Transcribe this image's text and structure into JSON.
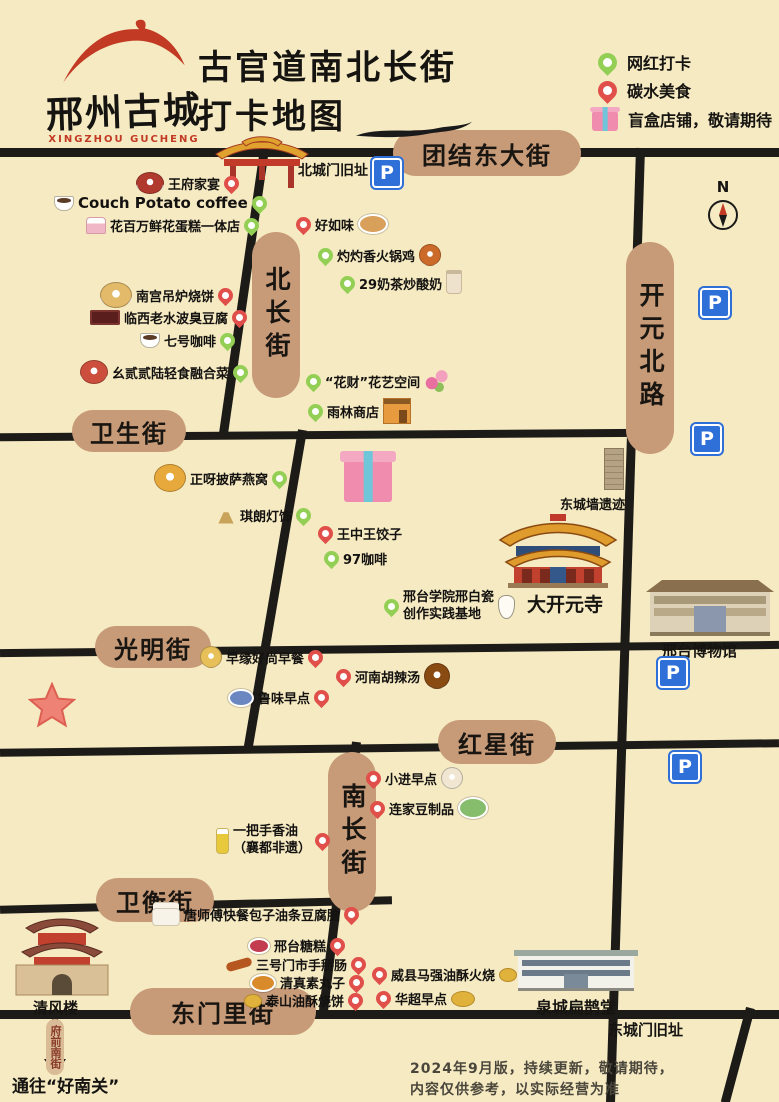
{
  "meta": {
    "logo_cn": "邢州古城",
    "logo_en": "XINGZHOU GUCHENG",
    "title_line1": "古官道南北长街",
    "title_line2": "打卡地图",
    "compass": "N"
  },
  "colors": {
    "background": "#f5eac2",
    "road": "#1d1b17",
    "street_pill": "#c79a78",
    "pin_red": "#e04f4a",
    "pin_green": "#94cf55",
    "parking_blue": "#2f6fd8",
    "logo_red": "#c23a24"
  },
  "legend": {
    "items": [
      {
        "icon": "green-pin",
        "label": "网红打卡"
      },
      {
        "icon": "red-pin",
        "label": "碳水美食"
      },
      {
        "icon": "giftbox",
        "label": "盲盒店铺，敬请期待"
      }
    ]
  },
  "streets": [
    {
      "label": "团结东大街"
    },
    {
      "label": "北长街"
    },
    {
      "label": "开元北路"
    },
    {
      "label": "卫生街"
    },
    {
      "label": "光明街"
    },
    {
      "label": "红星街"
    },
    {
      "label": "南长街"
    },
    {
      "label": "卫衡街"
    },
    {
      "label": "东门里街"
    }
  ],
  "landmarks": {
    "north_gate": "北城门旧址",
    "wall_relic": "东城墙遗迹",
    "temple": "大开元寺",
    "museum": "邢台博物馆",
    "quancheng_hall": "泉城扁鹊堂",
    "east_gate": "东城门旧址",
    "qingfeng_tower": "清风楼",
    "fuqian_street": "府前南街",
    "to_haonanguan": "通往“好南关”"
  },
  "notes": {
    "line1": "2024年9月版，持续更新，敬请期待，",
    "line2": "内容仅供参考，以实际经营为准"
  },
  "parking": {
    "label": "P",
    "positions": [
      {
        "x": 372,
        "y": 158
      },
      {
        "x": 700,
        "y": 288
      },
      {
        "x": 692,
        "y": 424
      },
      {
        "x": 658,
        "y": 658
      },
      {
        "x": 670,
        "y": 752
      }
    ]
  },
  "pois": [
    {
      "id": "wangfu-jiayan",
      "label": "王府家宴",
      "pin": "red",
      "icon": {
        "type": "round",
        "color": "#b03a2e",
        "w": 26,
        "h": 20
      },
      "order": [
        "icon",
        "label",
        "pin"
      ],
      "x": 136,
      "y": 172
    },
    {
      "id": "couch-potato-coffee",
      "label": "Couch Potato coffee",
      "pin": "green",
      "icon": {
        "type": "cup"
      },
      "order": [
        "icon",
        "label",
        "pin"
      ],
      "x": 54,
      "y": 194,
      "fs": 15
    },
    {
      "id": "huabaiwan-cake",
      "label": "花百万鲜花蛋糕一体店",
      "pin": "green",
      "icon": {
        "type": "cake"
      },
      "order": [
        "icon",
        "label",
        "pin"
      ],
      "x": 86,
      "y": 216
    },
    {
      "id": "haoruwei",
      "label": "好如味",
      "pin": "red",
      "icon": {
        "type": "oval",
        "color": "#d9a05b",
        "w": 26,
        "h": 16
      },
      "order": [
        "pin",
        "label",
        "icon"
      ],
      "x": 296,
      "y": 214
    },
    {
      "id": "zhuozhuoxiang",
      "label": "灼灼香火锅鸡",
      "pin": "green",
      "icon": {
        "type": "round",
        "color": "#cc6b29"
      },
      "order": [
        "pin",
        "label",
        "icon"
      ],
      "x": 318,
      "y": 244
    },
    {
      "id": "naicha-29",
      "label": "29奶茶炒酸奶",
      "pin": "green",
      "icon": {
        "type": "drink"
      },
      "order": [
        "pin",
        "label",
        "icon"
      ],
      "x": 340,
      "y": 272
    },
    {
      "id": "nangong-shaobing",
      "label": "南宫吊炉烧饼",
      "pin": "red",
      "icon": {
        "type": "round",
        "color": "#e3b96a",
        "w": 30,
        "h": 24
      },
      "order": [
        "icon",
        "label",
        "pin"
      ],
      "x": 100,
      "y": 282
    },
    {
      "id": "linxi-choudoufu",
      "label": "临西老水波臭豆腐",
      "pin": "red",
      "icon": {
        "type": "sign"
      },
      "order": [
        "icon",
        "label",
        "pin"
      ],
      "x": 90,
      "y": 308
    },
    {
      "id": "qihao-coffee",
      "label": "七号咖啡",
      "pin": "green",
      "icon": {
        "type": "cup"
      },
      "order": [
        "icon",
        "label",
        "pin"
      ],
      "x": 140,
      "y": 331
    },
    {
      "id": "yao-2226",
      "label": "幺贰贰陆轻食融合菜",
      "pin": "green",
      "icon": {
        "type": "round",
        "color": "#cc4f3d",
        "w": 26,
        "h": 22
      },
      "order": [
        "icon",
        "label",
        "pin"
      ],
      "x": 80,
      "y": 360
    },
    {
      "id": "huacai-flower",
      "label": "“花财”花艺空间",
      "pin": "green",
      "icon": {
        "type": "flower"
      },
      "order": [
        "pin",
        "label",
        "icon"
      ],
      "x": 306,
      "y": 370
    },
    {
      "id": "yulin-shop",
      "label": "雨林商店",
      "pin": "green",
      "icon": {
        "type": "shop"
      },
      "order": [
        "pin",
        "label",
        "icon"
      ],
      "x": 308,
      "y": 398
    },
    {
      "id": "pizza-yanwo",
      "label": "正呀披萨燕窝",
      "pin": "green",
      "icon": {
        "type": "round",
        "color": "#e8a93c",
        "w": 30,
        "h": 26
      },
      "order": [
        "icon",
        "label",
        "pin"
      ],
      "x": 154,
      "y": 464
    },
    {
      "id": "qilang-lighting",
      "label": "琪朗灯饰",
      "pin": "green",
      "icon": {
        "type": "lamp"
      },
      "order": [
        "icon",
        "label",
        "pin"
      ],
      "x": 216,
      "y": 506
    },
    {
      "id": "wangzhongwang-jiaozi",
      "label": "王中王饺子",
      "pin": "red",
      "order": [
        "pin",
        "label"
      ],
      "x": 318,
      "y": 524
    },
    {
      "id": "coffee-97",
      "label": "97咖啡",
      "pin": "green",
      "order": [
        "pin",
        "label"
      ],
      "x": 324,
      "y": 549
    },
    {
      "id": "xingtai-xueyuan",
      "lines": [
        "邢台学院邢白瓷",
        "创作实践基地"
      ],
      "pin": "green",
      "icon": {
        "type": "vase"
      },
      "order": [
        "pin",
        "label",
        "icon"
      ],
      "x": 384,
      "y": 590
    },
    {
      "id": "zaoyuan-breakfast",
      "label": "早缘好尚早餐",
      "pin": "red",
      "icon": {
        "type": "round",
        "color": "#e8c05a"
      },
      "order": [
        "icon",
        "label",
        "pin"
      ],
      "x": 200,
      "y": 646
    },
    {
      "id": "henan-hulatang",
      "label": "河南胡辣汤",
      "pin": "red",
      "icon": {
        "type": "round",
        "color": "#8a4b12",
        "w": 24,
        "h": 24
      },
      "order": [
        "pin",
        "label",
        "icon"
      ],
      "x": 336,
      "y": 663
    },
    {
      "id": "luwei-breakfast",
      "label": "鲁味早点",
      "pin": "red",
      "icon": {
        "type": "oval",
        "color": "#6a87c2"
      },
      "order": [
        "icon",
        "label",
        "pin"
      ],
      "x": 228,
      "y": 688
    },
    {
      "id": "xiaojin-breakfast",
      "label": "小进早点",
      "pin": "red",
      "icon": {
        "type": "round",
        "color": "#f0e6d2"
      },
      "order": [
        "pin",
        "label",
        "icon"
      ],
      "x": 366,
      "y": 767
    },
    {
      "id": "lianjia-tofu",
      "label": "连家豆制品",
      "pin": "red",
      "icon": {
        "type": "oval",
        "color": "#86bd6d",
        "w": 26,
        "h": 18
      },
      "order": [
        "pin",
        "label",
        "icon"
      ],
      "x": 370,
      "y": 797
    },
    {
      "id": "yibashou-oil",
      "lines": [
        "一把手香油",
        "（襄都非遗）"
      ],
      "pin": "red",
      "icon": {
        "type": "bottle"
      },
      "order": [
        "icon",
        "label",
        "pin"
      ],
      "x": 216,
      "y": 824
    },
    {
      "id": "tangshifu-kuaican",
      "label": "唐师傅快餐包子油条豆腐脑",
      "pin": "red",
      "icon": {
        "type": "steamer"
      },
      "order": [
        "icon",
        "label",
        "pin"
      ],
      "x": 152,
      "y": 902
    },
    {
      "id": "xingtai-tanggao",
      "label": "邢台糖糕",
      "pin": "red",
      "icon": {
        "type": "oval",
        "color": "#c23b4e",
        "w": 18,
        "h": 12
      },
      "order": [
        "icon",
        "label",
        "pin"
      ],
      "x": 248,
      "y": 936
    },
    {
      "id": "sanhao-shoubaichang",
      "label": "三号门市手掰肠",
      "pin": "red",
      "icon": {
        "type": "sausage"
      },
      "order": [
        "icon",
        "label",
        "pin"
      ],
      "x": 226,
      "y": 955
    },
    {
      "id": "qingzhen-suwanzi",
      "label": "清真素丸子",
      "pin": "red",
      "icon": {
        "type": "oval",
        "color": "#d98a2b"
      },
      "order": [
        "icon",
        "label",
        "pin"
      ],
      "x": 250,
      "y": 973
    },
    {
      "id": "taishan-shaobing",
      "label": "泰山油酥烧饼",
      "pin": "red",
      "icon": {
        "type": "coin"
      },
      "order": [
        "icon",
        "label",
        "pin"
      ],
      "x": 244,
      "y": 991
    },
    {
      "id": "weixian-huoshao",
      "label": "威县马强油酥火烧",
      "pin": "red",
      "icon": {
        "type": "coin"
      },
      "order": [
        "pin",
        "label",
        "icon"
      ],
      "x": 372,
      "y": 965
    },
    {
      "id": "huachao-breakfast",
      "label": "华超早点",
      "pin": "red",
      "icon": {
        "type": "coin",
        "w": 22,
        "h": 14
      },
      "order": [
        "pin",
        "label",
        "icon"
      ],
      "x": 376,
      "y": 989
    }
  ]
}
